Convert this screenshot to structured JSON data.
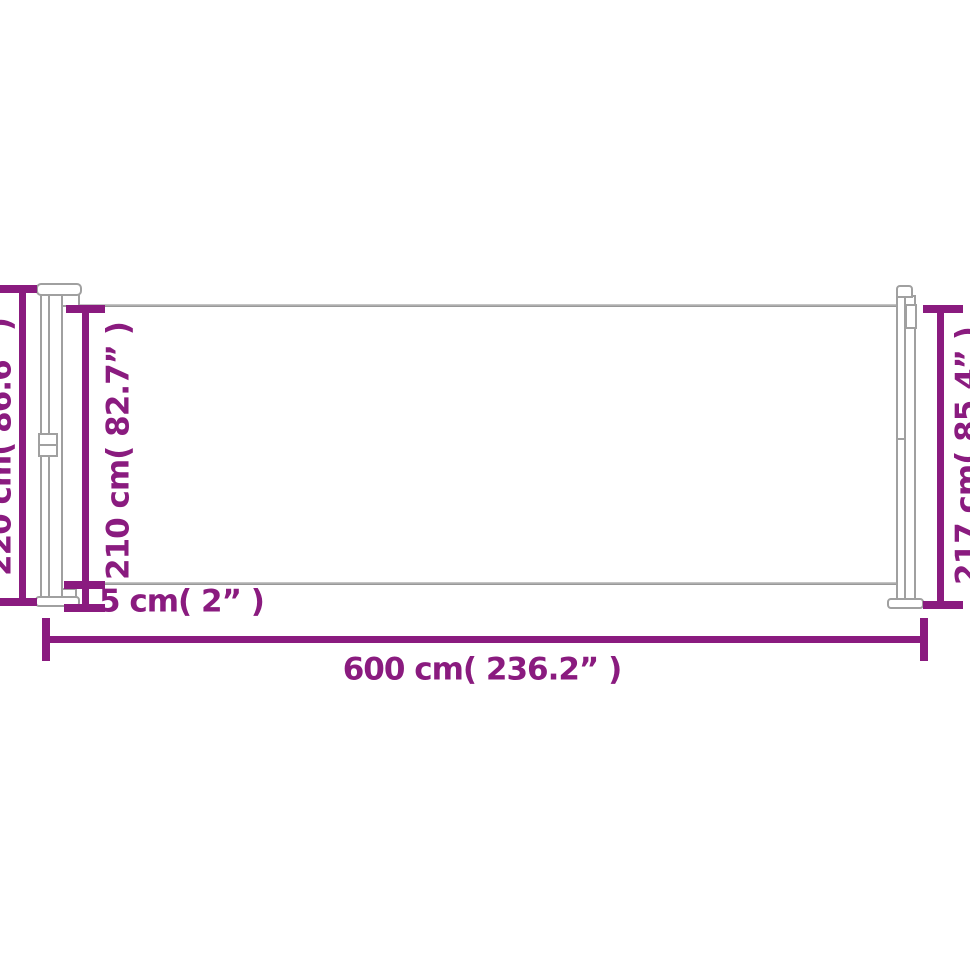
{
  "diagram": {
    "type": "product-dimensions",
    "subject": "retractable-side-awning",
    "labels": {
      "total_height_left": "220 cm( 86.6” )",
      "fabric_height": "210 cm( 82.7” )",
      "pole_height_right": "217 cm( 85.4” )",
      "bottom_gap": "5 cm( 2” )",
      "total_length": "600 cm( 236.2” )"
    },
    "measurements": [
      {
        "name": "total-height-left",
        "cm": 220,
        "inches": 86.6,
        "orientation": "vertical"
      },
      {
        "name": "fabric-height",
        "cm": 210,
        "inches": 82.7,
        "orientation": "vertical"
      },
      {
        "name": "pole-height-right",
        "cm": 217,
        "inches": 85.4,
        "orientation": "vertical"
      },
      {
        "name": "bottom-gap",
        "cm": 5,
        "inches": 2,
        "orientation": "vertical"
      },
      {
        "name": "total-length",
        "cm": 600,
        "inches": 236.2,
        "orientation": "horizontal"
      }
    ],
    "colors": {
      "dimension_accent": "#8a1b7f",
      "structure_outline": "#a0a0a0",
      "background": "#ffffff"
    }
  }
}
